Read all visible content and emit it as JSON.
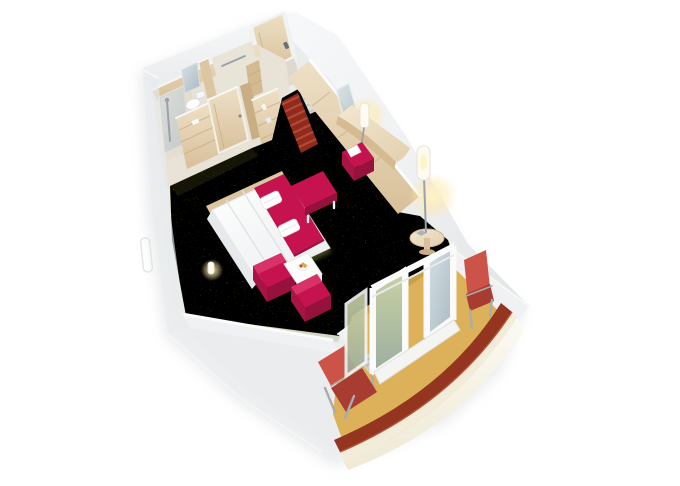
{
  "meta": {
    "description": "3D cutaway isometric rendering of a cruise-ship balcony cabin on a white background",
    "view": "axonometric cutaway, rotated diagonally top-left to bottom-right",
    "background": "#ffffff"
  },
  "palette": {
    "background": "#ffffff",
    "wall_white": "#f4f5f6",
    "wall_shade": "#e6e8ea",
    "wall_dark": "#d2d5d8",
    "wood": "#e9d9bc",
    "wood_mid": "#dcc6a2",
    "wood_dark": "#c9ae85",
    "tile": "#e8e3d6",
    "carpet": "#99a03e",
    "carpet_dark": "#6f7628",
    "carpet_light": "#b8bd5a",
    "crimson": "#c51350",
    "crimson_dark": "#96123c",
    "coral": "#cc5347",
    "coral_dark": "#a93c32",
    "balcony_floor": "#ddb05a",
    "balcony_shadow": "#c2953f",
    "hull_stripe": "#94351f",
    "hull_cream": "#f2ecd9",
    "mat_red_dark": "#8f2a1d",
    "mat_red_light": "#b24a33",
    "glass": "#c3d2d8",
    "chrome": "#9aa2a8",
    "pure_white": "#ffffff",
    "glow": "#ffe9a8"
  },
  "scene": {
    "hull": {
      "label": "white ship hull with dark red accent stripe along the curved balcony rail"
    },
    "bathroom": {
      "label": "bathroom with glass shower, toilet and mirror",
      "fixtures": [
        "shower",
        "toilet",
        "mirror",
        "towel-bar",
        "shelf-niche"
      ]
    },
    "wardrobe": {
      "label": "light wood wardrobe with open shelves and closet door"
    },
    "entrance": {
      "label": "cabin entrance door with striped doormats",
      "mats": [
        "grey-striped-mat",
        "red-striped-runner"
      ]
    },
    "living_area": {
      "label": "main cabin with olive-green carpet",
      "furniture": [
        "double-bed-with-crimson-runner",
        "two-folded-towels",
        "crimson-foot-bench",
        "two-crimson-armchairs",
        "white-coffee-table-with-fruit-bowl",
        "curved-wood-desk",
        "desk-lamp",
        "crimson-stool",
        "floor-lamp",
        "round-side-table",
        "bedside-lamp"
      ]
    },
    "balcony": {
      "label": "private balcony with ochre deck floor",
      "furniture": [
        "glass-sliding-doors",
        "red-deck-lounger",
        "red-deck-chair",
        "grey-slatted-table"
      ]
    }
  }
}
